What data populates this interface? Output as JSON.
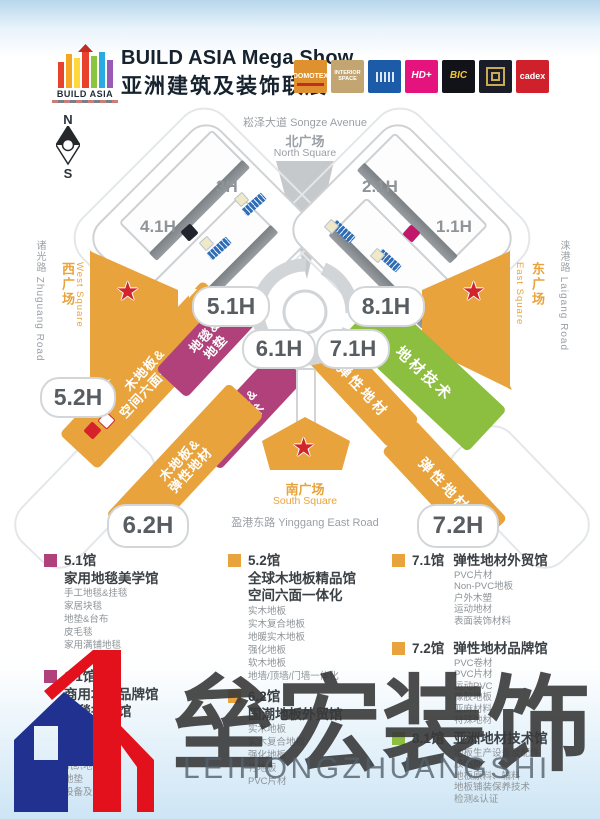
{
  "header": {
    "logo_text": "BUILD ASIA",
    "title_en": "BUILD ASIA Mega Show",
    "title_cn": "亚洲建筑及装饰联展",
    "badges": [
      {
        "label": "DOMOTEX",
        "bg": "#E0912F"
      },
      {
        "label": "INTERIOR SPACE",
        "bg": "#C3A572"
      },
      {
        "label": "",
        "bg": "#1C5BA8"
      },
      {
        "label": "HD+",
        "bg": "#E5137D"
      },
      {
        "label": "BIC",
        "bg": "#111318"
      },
      {
        "label": "",
        "bg": "#1A1C28"
      },
      {
        "label": "cadex",
        "bg": "#D0202B"
      }
    ]
  },
  "compass": {
    "n": "N",
    "s": "S"
  },
  "map": {
    "roads": {
      "north": "崧泽大道 Songze Avenue",
      "south": "盈港东路 Yinggang East Road",
      "west": "诸光路 Zhuguang Road",
      "east": "涞港路 Laigang Road"
    },
    "squares": {
      "north_cn": "北广场",
      "north_en": "North Square",
      "south_cn": "南广场",
      "south_en": "South Square",
      "west_cn": "西广场",
      "west_en": "West Square",
      "east_cn": "东广场",
      "east_en": "East Square"
    },
    "hall_labels": {
      "h3": "3H",
      "h4_1": "4.1H",
      "h2_1": "2.1H",
      "h1_1": "1.1H",
      "h5_1": "5.1H",
      "h8_1": "8.1H",
      "h6_1": "6.1H",
      "h7_1": "7.1H",
      "h5_2": "5.2H",
      "h6_2": "6.2H",
      "h7_2": "7.2H"
    },
    "zones": {
      "carpet_mat_l1": "地毯&",
      "carpet_mat_l2": "地垫",
      "carpet_tech_l1": "地毯&",
      "carpet_tech_l2": "技术",
      "wood_premium_l1": "木地板&",
      "wood_premium_l2": "空间六面一体化",
      "wood_resilient_l1": "木地板&",
      "wood_resilient_l2": "弹性地材",
      "resilient_71": "弹性地材",
      "resilient_72": "弹性地材",
      "material_tech": "地材技术"
    },
    "colors": {
      "orange": "#E8A33C",
      "magenta": "#B1417B",
      "green": "#8CBE3F",
      "star_red": "#D2252B"
    }
  },
  "legend": {
    "columns": [
      {
        "blocks": [
          {
            "color": "#B1417B",
            "no": "5.1馆",
            "name1": "家用地毯美学馆",
            "name2": "",
            "items": [
              "手工地毯&挂毯",
              "家居块毯",
              "地垫&台布",
              "皮毛毯",
              "家用满铺地毯"
            ]
          },
          {
            "color": "#B1417B",
            "no": "6.1馆",
            "name1": "商用地毯品牌馆",
            "name2": "地毯技术馆",
            "items": [
              "方块地毯",
              "商用满铺地毯",
              "原材料",
              "机织地毯",
              "地垫",
              "设备及辅料"
            ]
          }
        ]
      },
      {
        "blocks": [
          {
            "color": "#E8A33C",
            "no": "5.2馆",
            "name1": "全球木地板精品馆",
            "name2": "空间六面一体化",
            "items": [
              "实木地板",
              "实木复合地板",
              "地暖实木地板",
              "强化地板",
              "软木地板",
              "地墙/顶墙/门墙一体化"
            ]
          },
          {
            "color": "#E8A33C",
            "no": "6.2馆",
            "name1": "国潮地板外贸馆",
            "name2": "",
            "items": [
              "实木地板",
              "实木复合地板",
              "强化地板",
              "竹地板",
              "PVC片材"
            ]
          }
        ]
      },
      {
        "blocks": [
          {
            "color": "#E8A33C",
            "no": "7.1馆",
            "name": "弹性地材外贸馆",
            "items": [
              "PVC片材",
              "Non-PVC地板",
              "户外木塑",
              "运动地材",
              "表面装饰材料"
            ]
          },
          {
            "color": "#E8A33C",
            "no": "7.2馆",
            "name": "弹性地材品牌馆",
            "items": [
              "PVC卷材",
              "PVC片材",
              "运动PVC",
              "橡胶地板",
              "亚麻材料",
              "特殊地材"
            ]
          },
          {
            "color": "#8CBE3F",
            "no": "8.1馆",
            "name": "亚洲地材技术馆",
            "items": [
              "地板生产设备及配件",
              "胶粘剂",
              "地板原料、辅料",
              "地板铺装保养技术",
              "检测&认证"
            ]
          }
        ]
      }
    ]
  },
  "watermark": {
    "cn": "垒宏装饰",
    "en": "LEIHONGZHUANGSHI"
  }
}
